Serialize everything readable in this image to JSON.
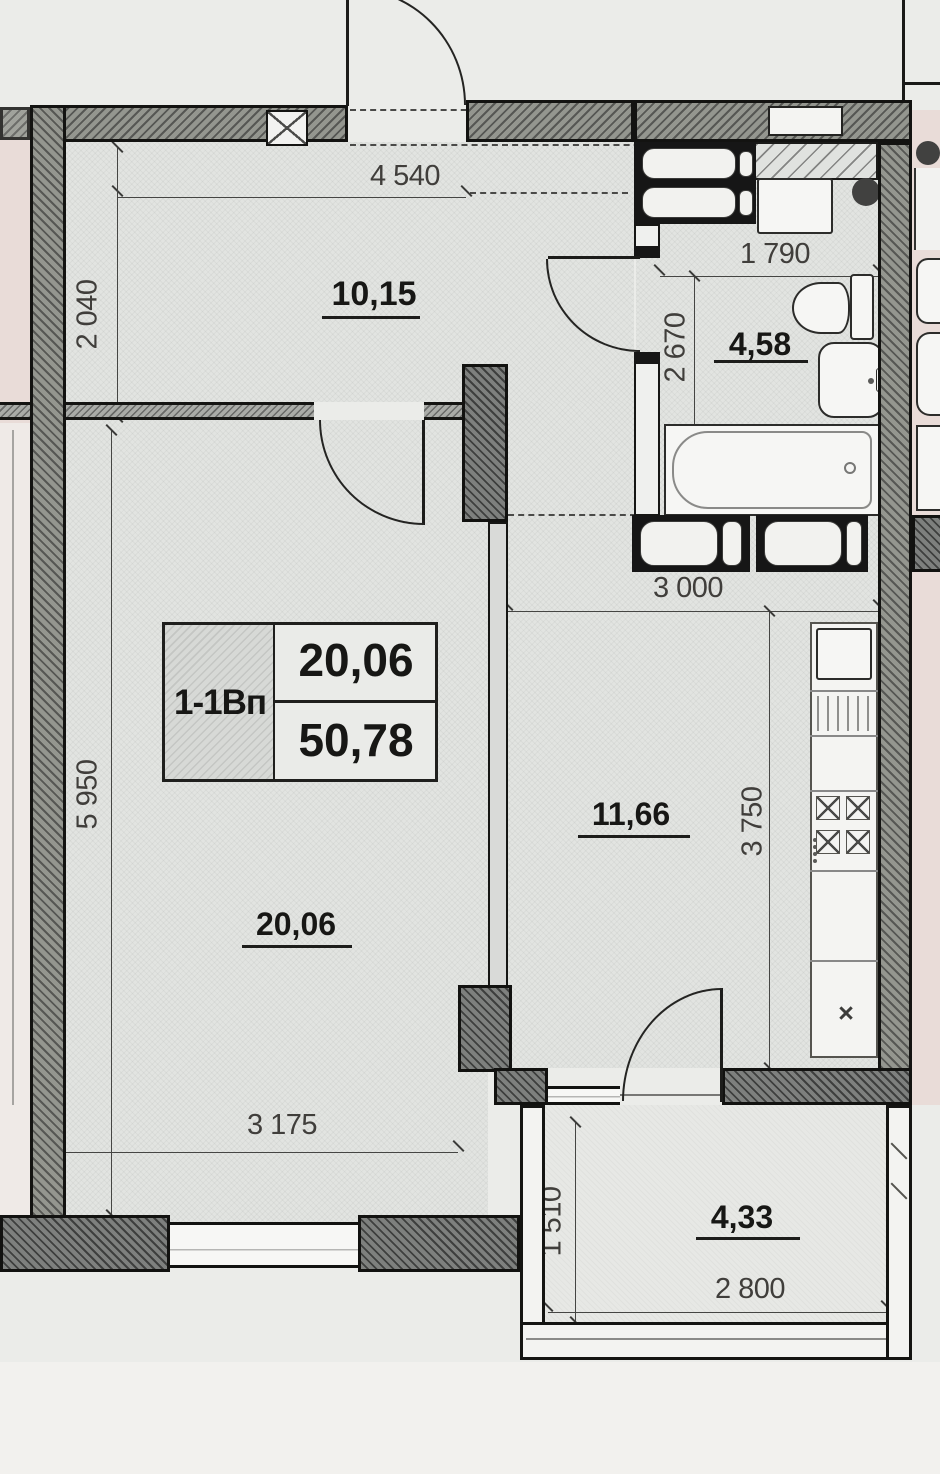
{
  "document": {
    "type": "apartment floor plan (scanned)",
    "palette": {
      "paper": "#ebece9",
      "paper_bottom": "#f2f1ee",
      "room_fill": "#e2e4e1",
      "balcony_fill": "#e7e8e5",
      "neighbor_fill": "#e9dcd8",
      "wall_fill": "#94968f",
      "wall_dark_fill": "#7e807e",
      "line": "#1a1a18",
      "dim_text": "#403e3b",
      "area_text": "#171715"
    }
  },
  "unit_box": {
    "code": "1-1Вп",
    "upper": "20,06",
    "lower": "50,78"
  },
  "rooms": {
    "hall": {
      "area": "10,15"
    },
    "bathroom": {
      "area": "4,58"
    },
    "living": {
      "area": "20,06"
    },
    "kitchen": {
      "area": "11,66"
    },
    "balcony": {
      "area": "4,33"
    }
  },
  "dimensions": {
    "hall_width": "4 540",
    "hall_depth": "2 040",
    "bath_width": "1 790",
    "bath_depth": "2 670",
    "kitchen_width": "3 000",
    "kitchen_depth": "3 750",
    "living_depth": "5 950",
    "living_window_width": "3 175",
    "balcony_depth": "1 510",
    "balcony_width": "2 800"
  },
  "symbols": {
    "boiler_mark": "×"
  },
  "icons": {
    "toilet-icon": "css-shape",
    "sink-icon": "css-shape",
    "bathtub-icon": "css-shape",
    "washing-machine-icon": "css-rect",
    "vent-duct-icon": "css-rounded-rect",
    "vent-hole-icon": "css-circle",
    "fridge-icon": "css-rect",
    "stove-burner-icon": "css-x-square",
    "sink-drainer-icon": "css-lines",
    "wall-vent-icon": "css-x-box",
    "door-swing-icon": "css-quarter-arc",
    "window-icon": "css-double-line",
    "boiler-icon": "unicode-x"
  }
}
